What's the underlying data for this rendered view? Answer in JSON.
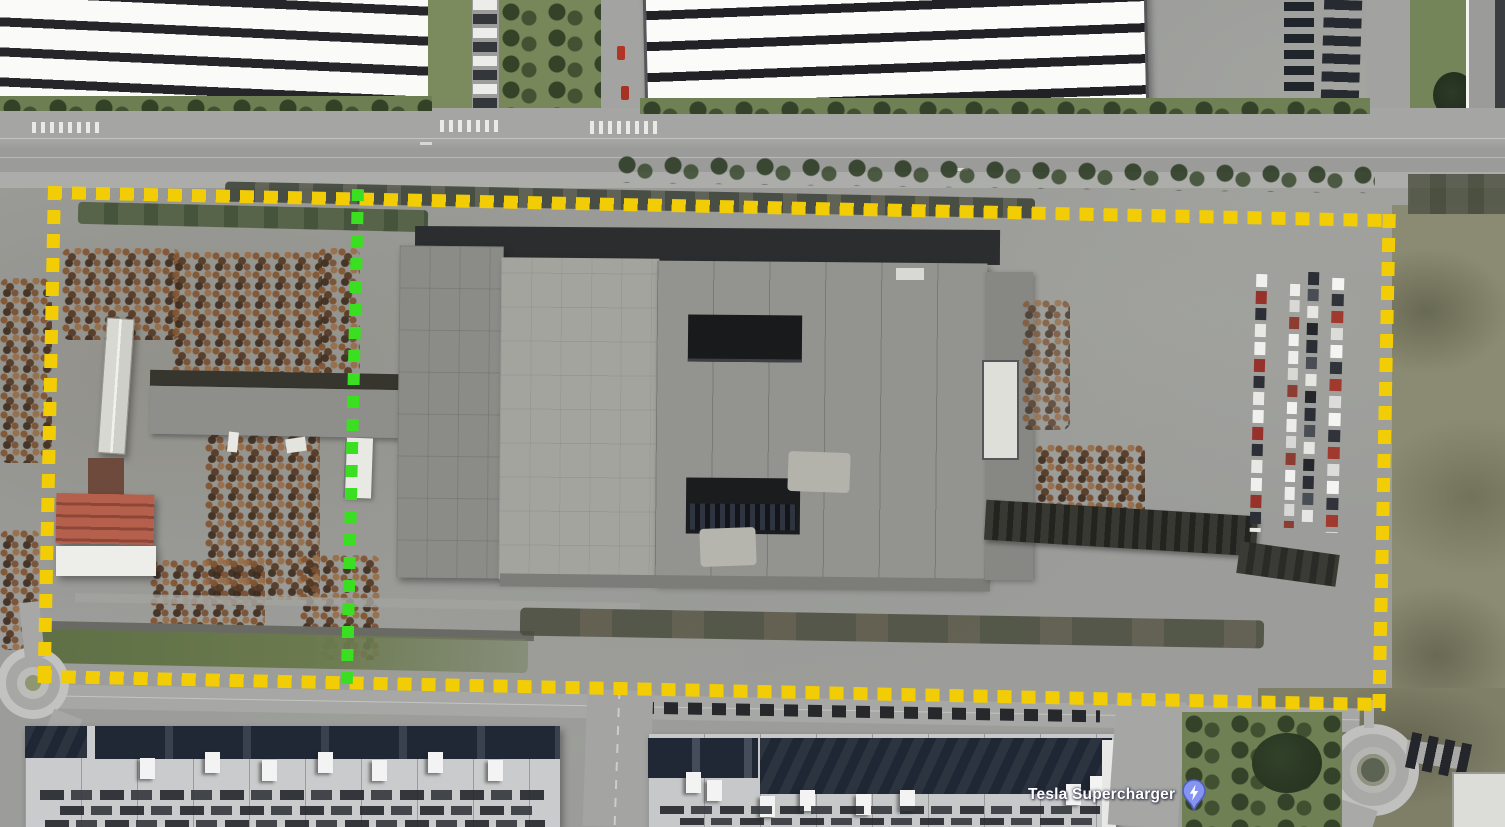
{
  "app": {
    "surface": "satellite-map-view"
  },
  "map": {
    "poi": {
      "name": "Tesla Supercharger",
      "icon": "ev-charger-pin-icon",
      "glyph": "lightning-bolt",
      "pin_fill": "#8494f0",
      "pin_stroke": "#4d5fc0",
      "label_color": "#ffffff"
    }
  },
  "overlays": {
    "site_boundary": {
      "shape": "rectangle",
      "stroke_style": "dotted",
      "color": "#f2cd05"
    },
    "divider": {
      "shape": "line",
      "orientation": "vertical",
      "stroke_style": "dotted",
      "color": "#3bdf22"
    }
  }
}
